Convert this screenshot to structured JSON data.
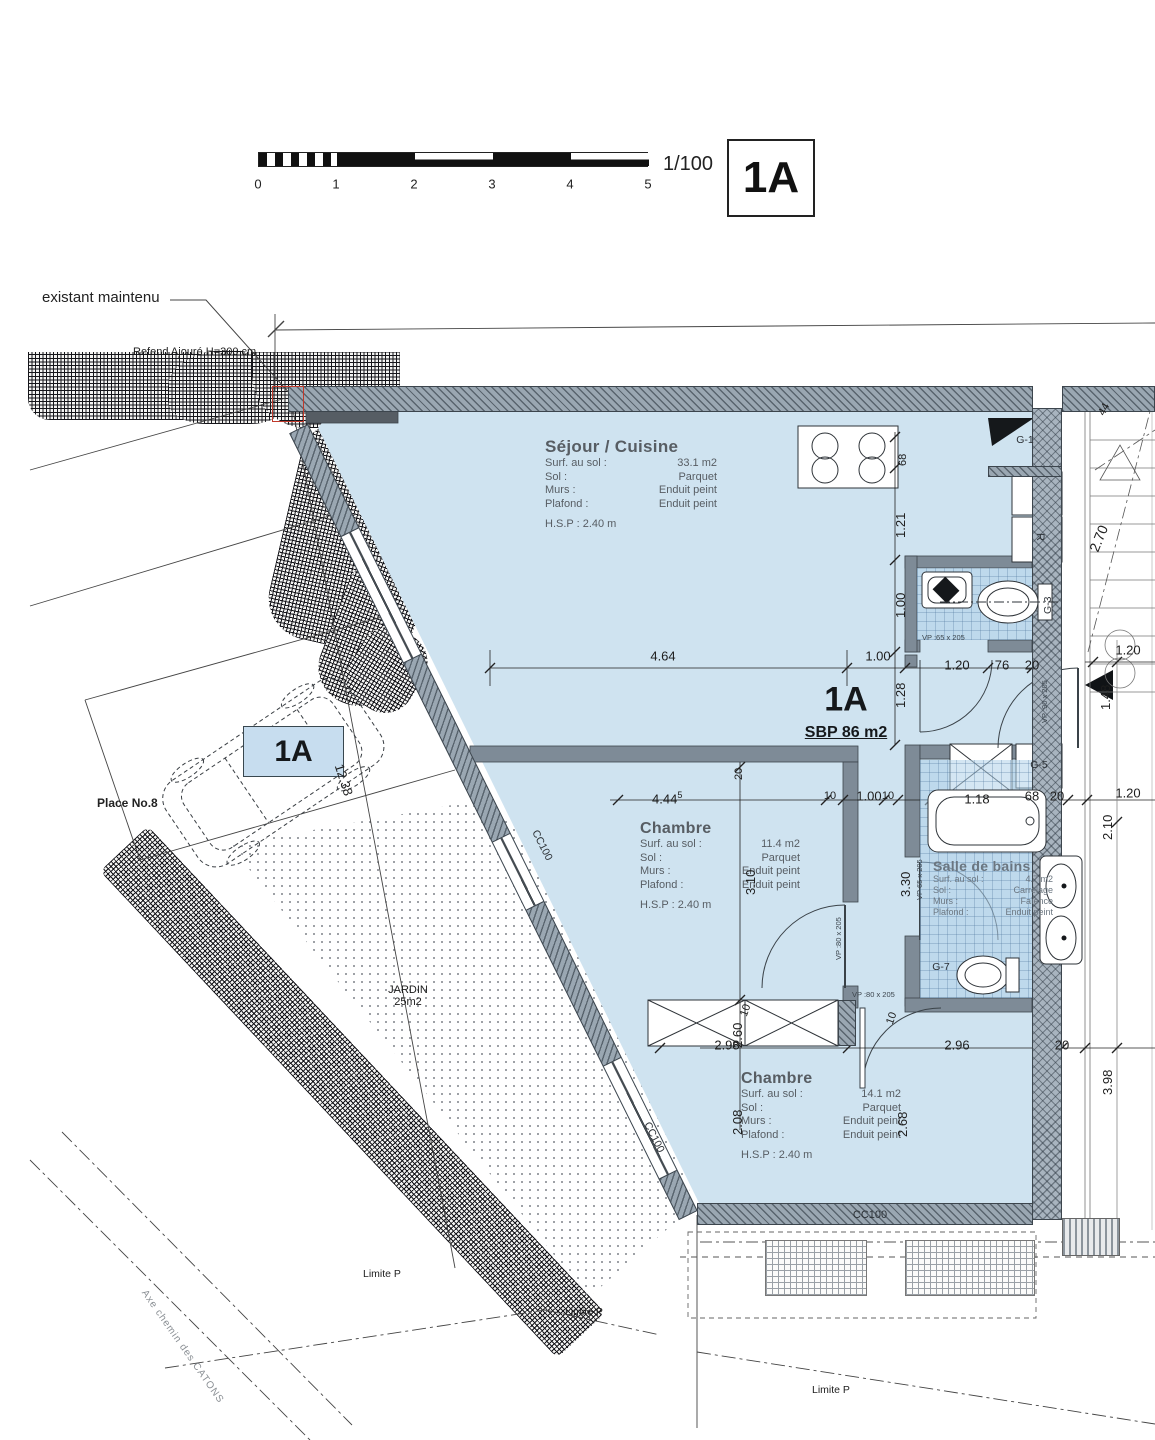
{
  "colors": {
    "room_fill": "#cfe3f0",
    "wall_gray": "#9aa7b2",
    "wall_dark": "#565d64",
    "accent_red": "#c0392b",
    "parking_fill": "#c7ddef"
  },
  "scalebar": {
    "ticks": [
      "0",
      "1",
      "2",
      "3",
      "4",
      "5"
    ],
    "ratio": "1/100",
    "badge": "1A"
  },
  "unit": {
    "name": "1A",
    "sbp": "SBP 86 m2"
  },
  "rooms": {
    "sejour": {
      "title": "Séjour / Cuisine",
      "rows": [
        [
          "Surf. au sol :",
          "33.1 m2"
        ],
        [
          "Sol :",
          "Parquet"
        ],
        [
          "Murs :",
          "Enduit peint"
        ],
        [
          "Plafond :",
          "Enduit peint"
        ]
      ],
      "hsp": "H.S.P : 2.40 m"
    },
    "chambre1": {
      "title": "Chambre",
      "rows": [
        [
          "Surf. au sol :",
          "11.4 m2"
        ],
        [
          "Sol :",
          "Parquet"
        ],
        [
          "Murs :",
          "Enduit peint"
        ],
        [
          "Plafond :",
          "Enduit peint"
        ]
      ],
      "hsp": "H.S.P : 2.40 m"
    },
    "chambre2": {
      "title": "Chambre",
      "rows": [
        [
          "Surf. au sol :",
          "14.1 m2"
        ],
        [
          "Sol :",
          "Parquet"
        ],
        [
          "Murs :",
          "Enduit peint"
        ],
        [
          "Plafond :",
          "Enduit peint"
        ]
      ],
      "hsp": "H.S.P : 2.40 m"
    },
    "bains": {
      "title": "Salle de bains",
      "rows": [
        [
          "Surf. au sol :",
          "4.7 m2"
        ],
        [
          "Sol :",
          "Carrelage"
        ],
        [
          "Murs :",
          "Faïence"
        ],
        [
          "Plafond :",
          "Enduit peint"
        ]
      ]
    }
  },
  "dims": {
    "sejour_w": "4.64",
    "hall_w": "1.00",
    "v68": "68",
    "v121": "1.21",
    "v100": "1.00",
    "v128": "1.28",
    "door_120": "1.20",
    "d76": "76",
    "d20a": "20",
    "ext_top": "1.20",
    "v148": "1.48",
    "v44": "44",
    "stair_270": "2.70",
    "ch1_w": "4.44",
    "ch1_w_sup": "5",
    "d10a": "10",
    "mid_100": "1.00",
    "d10b": "10",
    "bath_118": "1.18",
    "d68b": "68",
    "d20b": "20",
    "ext_mid": "1.20",
    "v210": "2.10",
    "v20": "20",
    "v310": "3.10",
    "v330": "3.30",
    "v10a": "10",
    "v10b": "10",
    "v260": "2.60",
    "v208": "2.08",
    "v268": "2.68",
    "ch2_l": "2.98",
    "ch2_w": "2.96",
    "d20c": "20",
    "v398": "3.98",
    "parking": "12.38"
  },
  "openings": {
    "vp65": "VP :65 x 205",
    "vp65b": "VP 65 x 205",
    "vp80a": "VP :80 x 205",
    "vp80b": "VP :80 x 205",
    "vp90": "VP :90 x 205",
    "cc100a": "CC100",
    "cc100b": "CC100",
    "cc100c": "CC100"
  },
  "equip": {
    "g1": "G-1",
    "g3": "G-3",
    "g5": "G-5",
    "g7": "G-7",
    "r": "R"
  },
  "site": {
    "existant": "existant maintenu",
    "refend": "Refend Ajouré  H=300 cm",
    "place": "Place No.8",
    "parking_badge": "1A",
    "jardin_title": "JARDIN",
    "jardin_area": "25m2",
    "limite1": "Limite P",
    "limite2": "Limite P",
    "limite3": "Limite P",
    "axe": "Axe chemin des CATONS"
  }
}
